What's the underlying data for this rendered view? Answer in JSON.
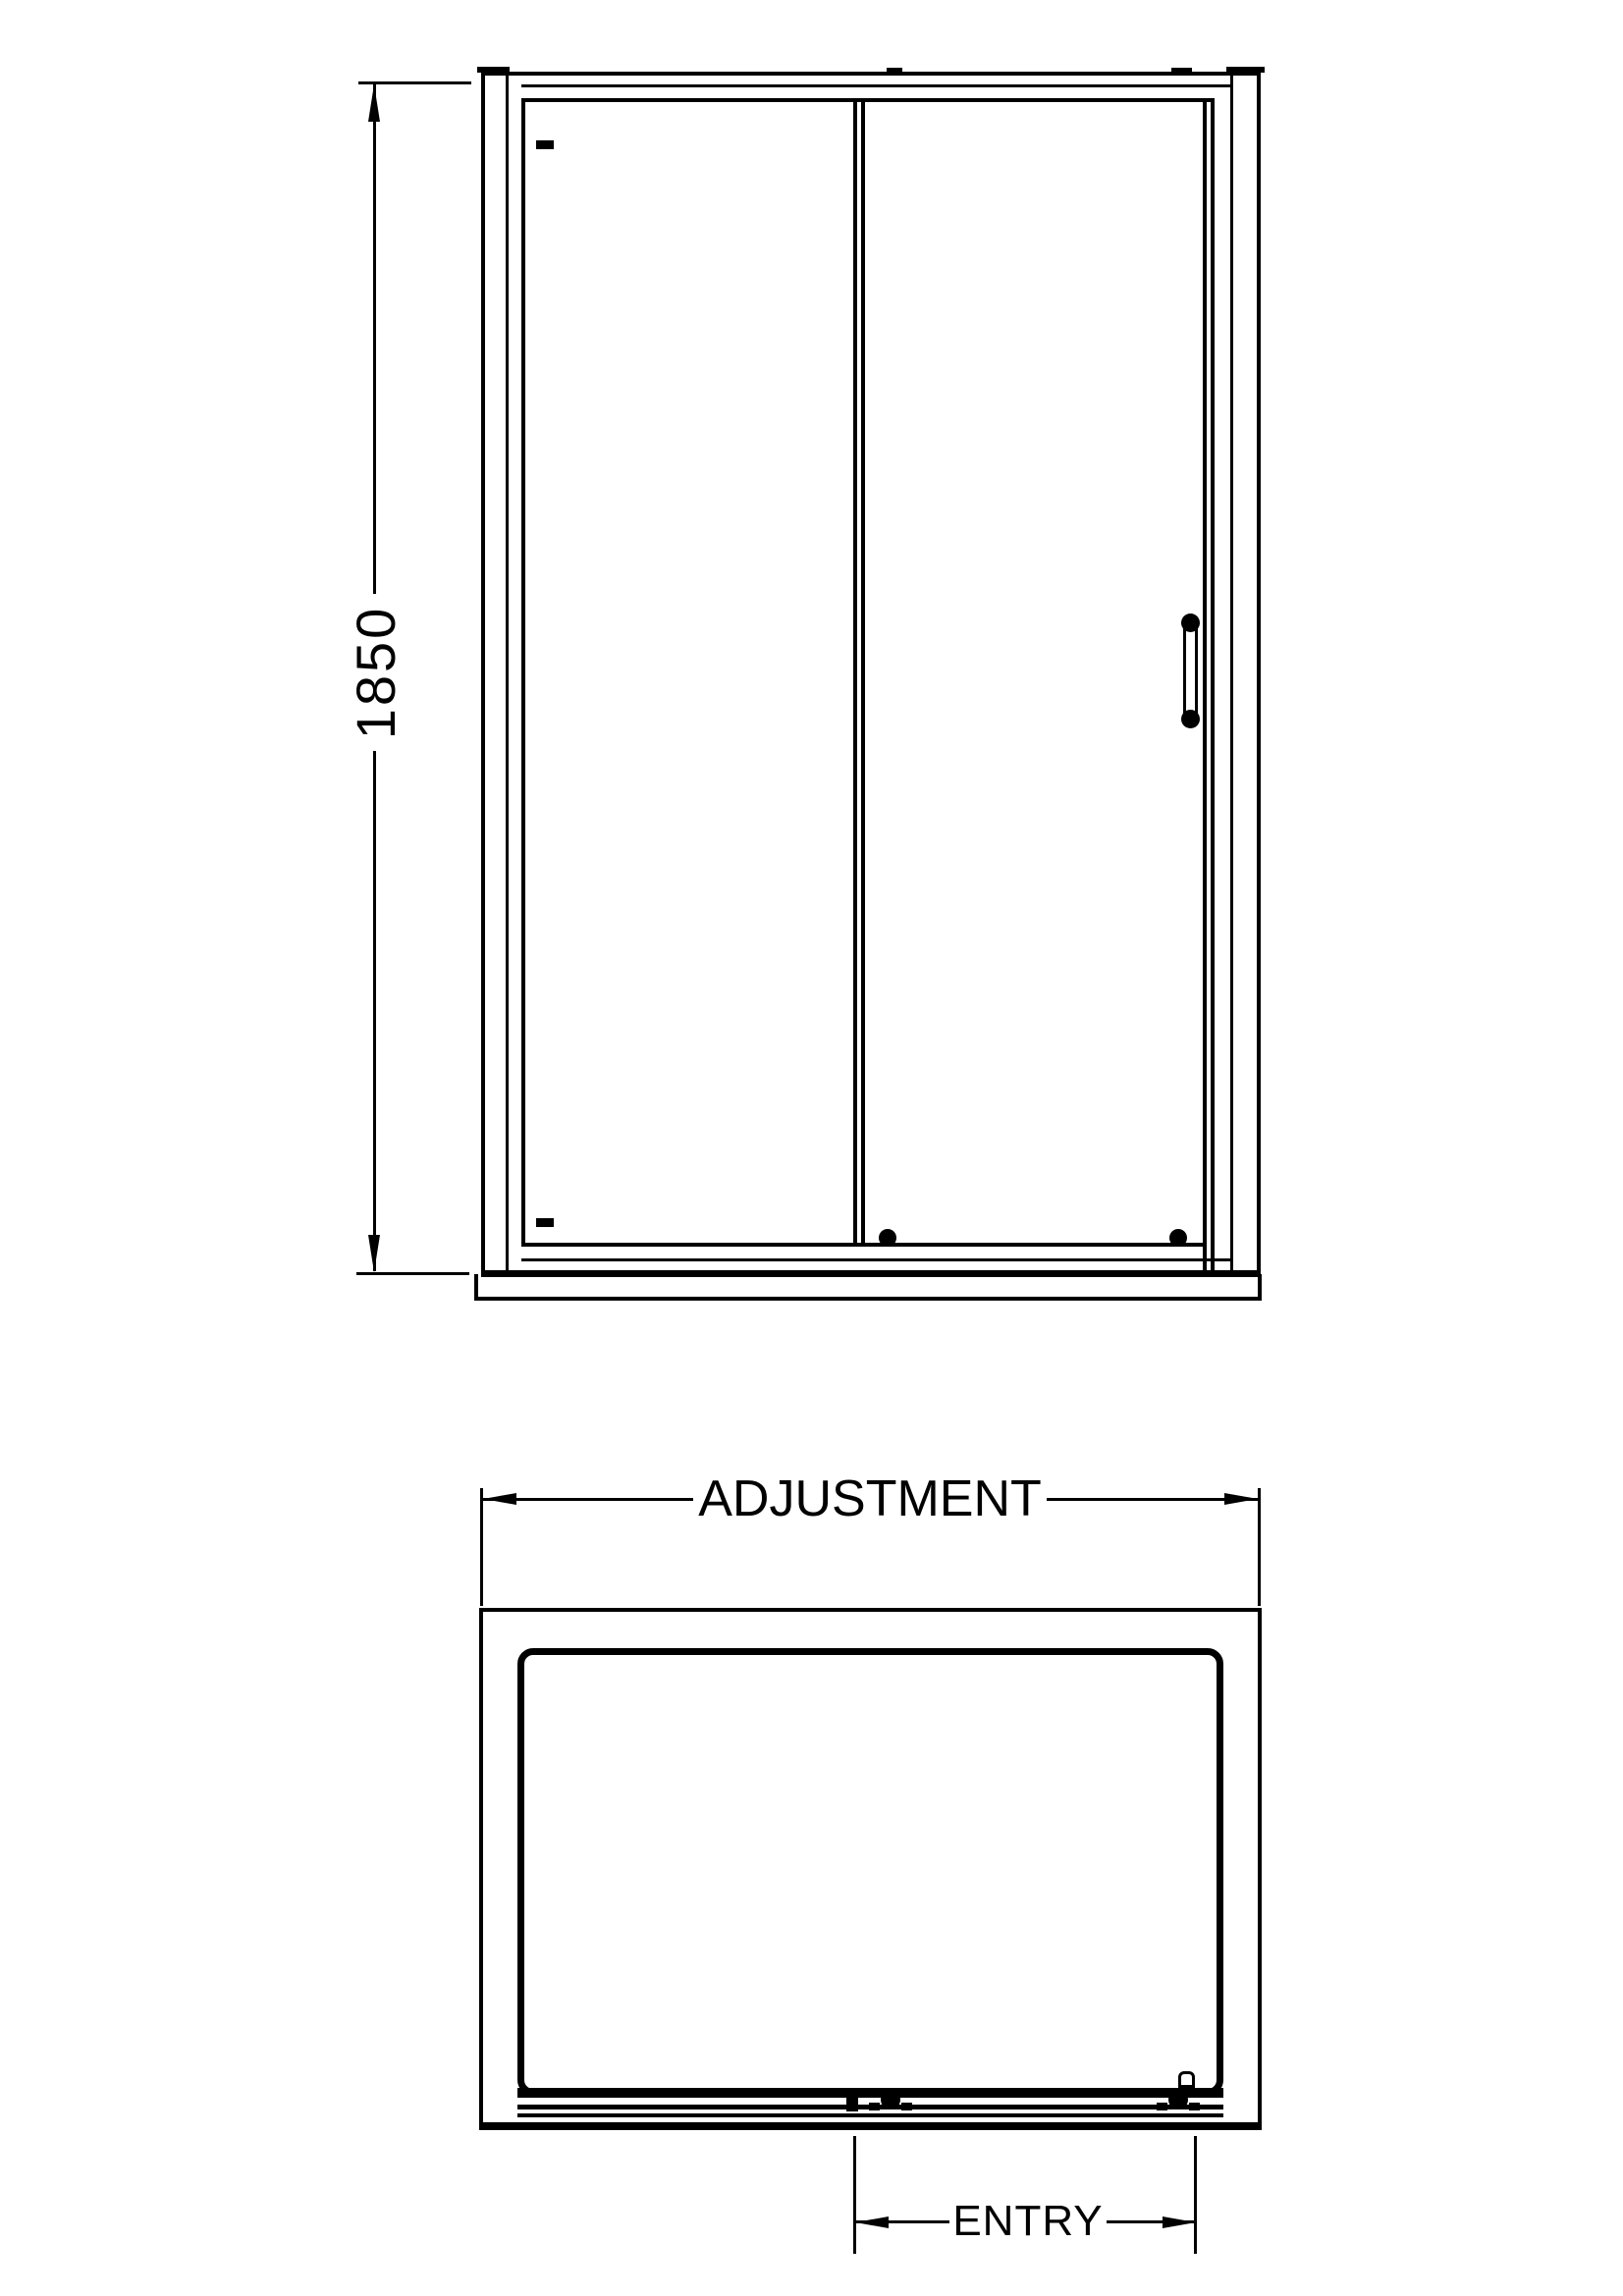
{
  "drawing": {
    "background_color": "#ffffff",
    "line_color": "#000000",
    "elevation": {
      "name": "front-elevation",
      "height_dimension": {
        "value": "1850"
      }
    },
    "plan": {
      "name": "plan-view",
      "adjustment_dimension": {
        "label": "ADJUSTMENT"
      },
      "entry_dimension": {
        "label": "ENTRY"
      }
    }
  }
}
